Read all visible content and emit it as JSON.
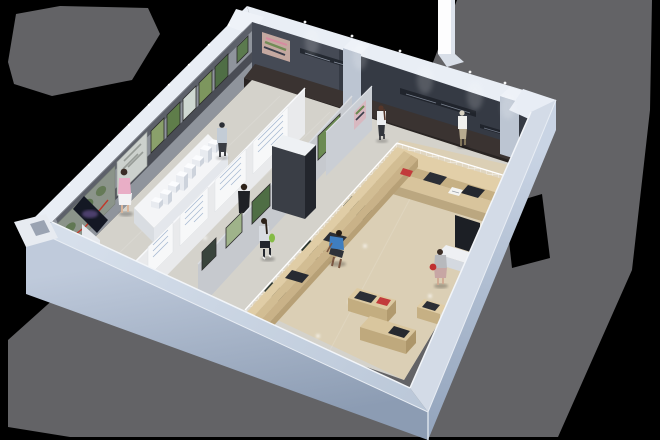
{
  "scene": {
    "description": "3D axonometric cutaway render of an exhibition gallery interior with visitors, artwork walls, partitions, a white city model, wire-mesh partition, tiered plywood seating and benches, on a gray drop shadow over a black background",
    "type": "architectural-render",
    "zones": {
      "left": "gallery with framed photos, satellite map mural, text panels and white scale model",
      "right": "lounge with wire mesh enclosure, plywood tiers, benches and reading material"
    },
    "people_count": 8
  },
  "colors": {
    "background": "#000000",
    "shadow": "#636366",
    "cap": "#e9eef5",
    "wall_nw": "#8f949c",
    "wall_ne_left": "#454a55",
    "wall_ne": "#353a44",
    "wall_rail": "#4a4d55",
    "ext_top_sw": "#c7d1e0",
    "ext_face_sw": "#a5b2c5",
    "ext_face_se": "#b5c1d3",
    "floor_left": "#d4d2cb",
    "floor_right": "#dbcfb5",
    "bench_dark_top": "#3a3331",
    "bench_dark_front": "#292422",
    "wood": "#e2cfa8",
    "wood_front": "#c6b084",
    "cushion": "#2b2e35",
    "partition_white": "#e9eaec",
    "partition_gray": "#c6c9ce",
    "partition_small": "#caced4",
    "monolith_light_top": "#eef1f4",
    "monolith_sw": "#3a3e46",
    "monolith_se": "#23262d",
    "banner": "#fdfdfe",
    "mesh_line": "#ffffff",
    "plaque_green": "#2f3a33",
    "accent_red": "#c23b3b",
    "art_green": "#4f6e45",
    "map_base": "#8b948a",
    "route_red": "#c0392b",
    "kiosk_screen": "#141824",
    "desk_dark": "#1c1f25",
    "counter_white": "#eef0f3"
  },
  "artworks": {
    "nw_frames": [
      "green-landscape",
      "green-field",
      "pale-cityscape",
      "forest",
      "meadow"
    ],
    "satellite_map": "aerial map mural with red route line",
    "city_collage": "grey city photo collage",
    "ne_color_map": "pink and green route map artwork",
    "signage": "illegible light lettering strips on dark wall"
  },
  "people": [
    {
      "name": "woman-pink",
      "top_color": "#e9aec6",
      "bottom_color": "#f2f2f4",
      "hair": "#3a2c26"
    },
    {
      "name": "woman-cap",
      "top_color": "#c3ccd6",
      "bottom_color": "#3a3d44",
      "hair": "#2b2f36"
    },
    {
      "name": "man-suit",
      "top_color": "#1f2125",
      "bottom_color": "#1a1c20",
      "hair": "#2e2219"
    },
    {
      "name": "girl-green-bag",
      "top_color": "#d8dce2",
      "bottom_color": "#23262e",
      "bag": "#85bb45"
    },
    {
      "name": "man-sitting",
      "top_color": "#3f7ec0",
      "bottom_color": "#2e3138",
      "skin": "#7a5540"
    },
    {
      "name": "woman-red-bag",
      "top_color": "#b7b9bd",
      "bottom_color": "#c7a6a4",
      "bag": "#c03030"
    },
    {
      "name": "man-mesh",
      "top_color": "#f0f0ee",
      "bottom_color": "#b8ab90",
      "hair": "#d8d2c2"
    },
    {
      "name": "woman-white",
      "top_color": "#eceef0",
      "bottom_color": "#33363c",
      "hair": "#55362a"
    }
  ]
}
